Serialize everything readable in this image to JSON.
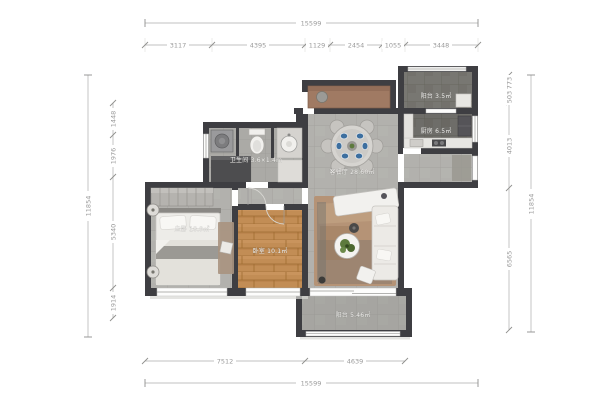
{
  "title": "apartment-floor-plan",
  "dimensions": {
    "top_total": "15599",
    "top_segments": [
      "3117",
      "4395",
      "1129",
      "2454",
      "1055",
      "3448"
    ],
    "left_total": "11854",
    "left_segments": [
      "1448",
      "1976",
      "5340",
      "1914"
    ],
    "right_total": "11854",
    "right_segments": [
      "773",
      "503",
      "4013",
      "6565"
    ],
    "bottom_segments": [
      "7512",
      "4639"
    ],
    "bottom_total": "15599"
  },
  "rooms": {
    "living_dining": {
      "label": "客餐厅 28.60㎡"
    },
    "master_bedroom": {
      "label": "主卧 18.9㎡"
    },
    "bedroom2": {
      "label": "卧室 10.1㎡"
    },
    "bathroom": {
      "label": "卫生间 3.6×1.4m"
    },
    "kitchen": {
      "label": "厨房 6.5㎡"
    },
    "balcony_top": {
      "label": "阳台 3.5㎡"
    },
    "balcony_bottom": {
      "label": "阳台 5.46㎡"
    }
  },
  "colors": {
    "wall": "#3e3e42",
    "tile_floor": "#b2b1ad",
    "bath_tile": "#abaaa6",
    "kitchen_tile": "#787772",
    "wood_floor": "#c28d55",
    "rug_tan": "#b59376",
    "plate_blue": "#3d6f9f",
    "dimension_text": "#9a9a9a",
    "background": "#ffffff"
  }
}
